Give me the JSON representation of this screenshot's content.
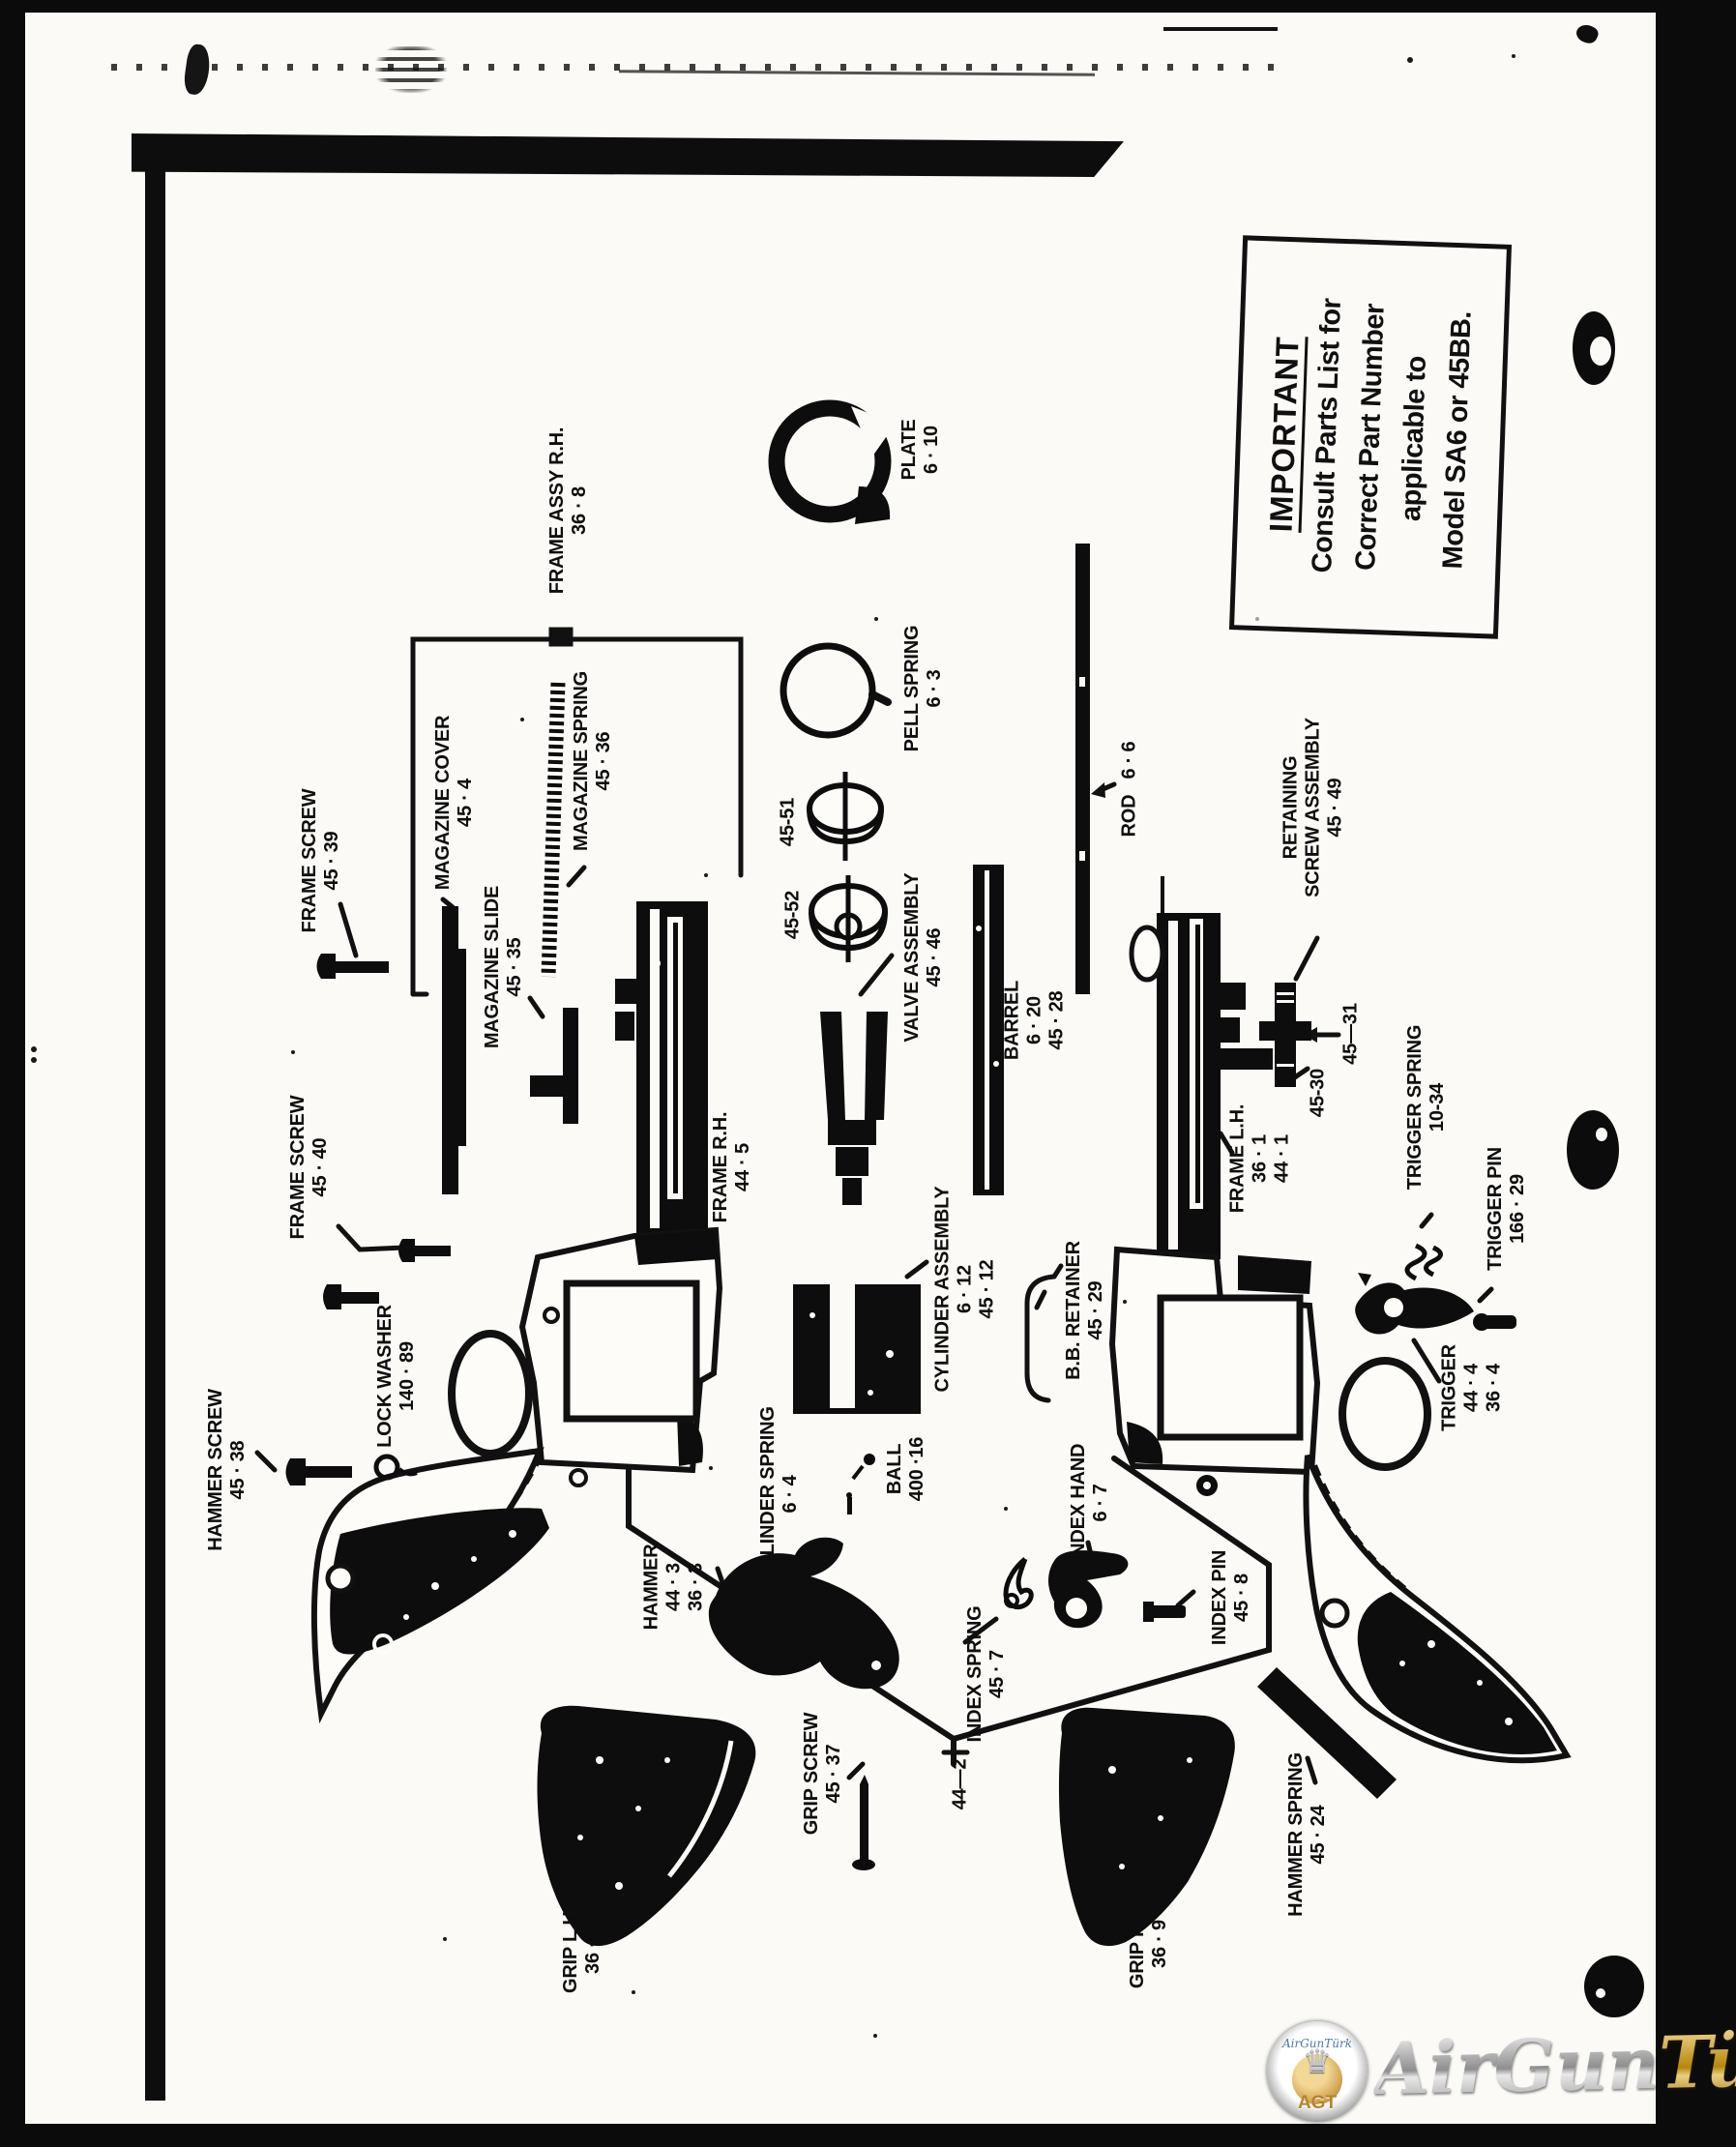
{
  "notice": {
    "title": "IMPORTANT",
    "lines": [
      "Consult Parts List for",
      "Correct Part Number",
      "applicable to",
      "Model SA6 or 45BB."
    ]
  },
  "labels": {
    "frame_screw_39": {
      "lines": [
        "FRAME SCREW",
        "45 · 39"
      ]
    },
    "magazine_cover": {
      "lines": [
        "MAGAZINE COVER",
        "45 · 4"
      ]
    },
    "magazine_slide": {
      "lines": [
        "MAGAZINE SLIDE",
        "45 · 35"
      ]
    },
    "magazine_spring": {
      "lines": [
        "MAGAZINE SPRING",
        "45 · 36"
      ]
    },
    "frame_assy_rh": {
      "lines": [
        "FRAME ASSY R.H.",
        "36 · 8"
      ]
    },
    "plate": {
      "lines": [
        "PLATE",
        "6 · 10"
      ]
    },
    "pell_spring": {
      "lines": [
        "PELL SPRING",
        "6 · 3"
      ]
    },
    "n45_51": {
      "lines": [
        "45-51"
      ]
    },
    "n45_52": {
      "lines": [
        "45-52"
      ]
    },
    "valve_assembly": {
      "lines": [
        "VALVE ASSEMBLY",
        "45 · 46"
      ]
    },
    "barrel": {
      "lines": [
        "BARREL",
        "6 · 20",
        "45 · 28"
      ]
    },
    "rod": {
      "lines": [
        "ROD   6 · 6"
      ]
    },
    "retaining_screw": {
      "lines": [
        "RETAINING",
        "SCREW ASSEMBLY",
        "45 · 49"
      ]
    },
    "n45_30": {
      "lines": [
        "45-30"
      ]
    },
    "n45_31": {
      "lines": [
        "45—31"
      ]
    },
    "frame_lh": {
      "lines": [
        "FRAME L.H.",
        "36 · 1",
        "44 · 1"
      ]
    },
    "trigger_spring": {
      "lines": [
        "TRIGGER SPRING",
        "10-34"
      ]
    },
    "trigger_pin": {
      "lines": [
        "TRIGGER PIN",
        "166 · 29"
      ]
    },
    "trigger": {
      "lines": [
        "TRIGGER",
        "44 · 4",
        "36 · 4"
      ]
    },
    "frame_screw_40": {
      "lines": [
        "FRAME SCREW",
        "45 · 40"
      ]
    },
    "lock_washer": {
      "lines": [
        "LOCK WASHER",
        "140 · 89"
      ]
    },
    "hammer_screw": {
      "lines": [
        "HAMMER SCREW",
        "45 · 38"
      ]
    },
    "frame_rh": {
      "lines": [
        "FRAME R.H.",
        "44 · 5"
      ]
    },
    "cylinder_assembly": {
      "lines": [
        "CYLINDER ASSEMBLY",
        "6 · 12",
        "45 · 12"
      ]
    },
    "bb_retainer": {
      "lines": [
        "B.B. RETAINER",
        "45 · 29"
      ]
    },
    "cylinder_spring": {
      "lines": [
        "CYLINDER SPRING",
        "6 · 4"
      ]
    },
    "ball": {
      "lines": [
        "BALL",
        "400 ·16"
      ]
    },
    "hammer": {
      "lines": [
        "HAMMER",
        "44 · 3",
        "36 · 3"
      ]
    },
    "index_spring": {
      "lines": [
        "INDEX SPRING",
        "45 · 7"
      ]
    },
    "index_hand": {
      "lines": [
        "INDEX HAND",
        "6 · 7"
      ]
    },
    "index_pin": {
      "lines": [
        "INDEX PIN",
        "45 · 8"
      ]
    },
    "n44_2": {
      "lines": [
        "44—2"
      ]
    },
    "grip_screw": {
      "lines": [
        "GRIP SCREW",
        "45 · 37"
      ]
    },
    "grip_lh": {
      "lines": [
        "GRIP L.H.",
        "36 · 5"
      ]
    },
    "grip_rh": {
      "lines": [
        "GRIP R.H.",
        "36 · 9"
      ]
    },
    "hammer_spring": {
      "lines": [
        "HAMMER SPRING",
        "45 · 24"
      ]
    }
  },
  "watermark": {
    "brand_silver": "AirGun",
    "brand_gold": "Türk",
    "badge_text": "AGT",
    "badge_script": "AirGunTürk"
  },
  "colors": {
    "ink": "#101010",
    "paper": "#fbfaf6",
    "gold": "#b5832a",
    "silver": "#9a9a9a",
    "blue": "#4a7ab5"
  }
}
